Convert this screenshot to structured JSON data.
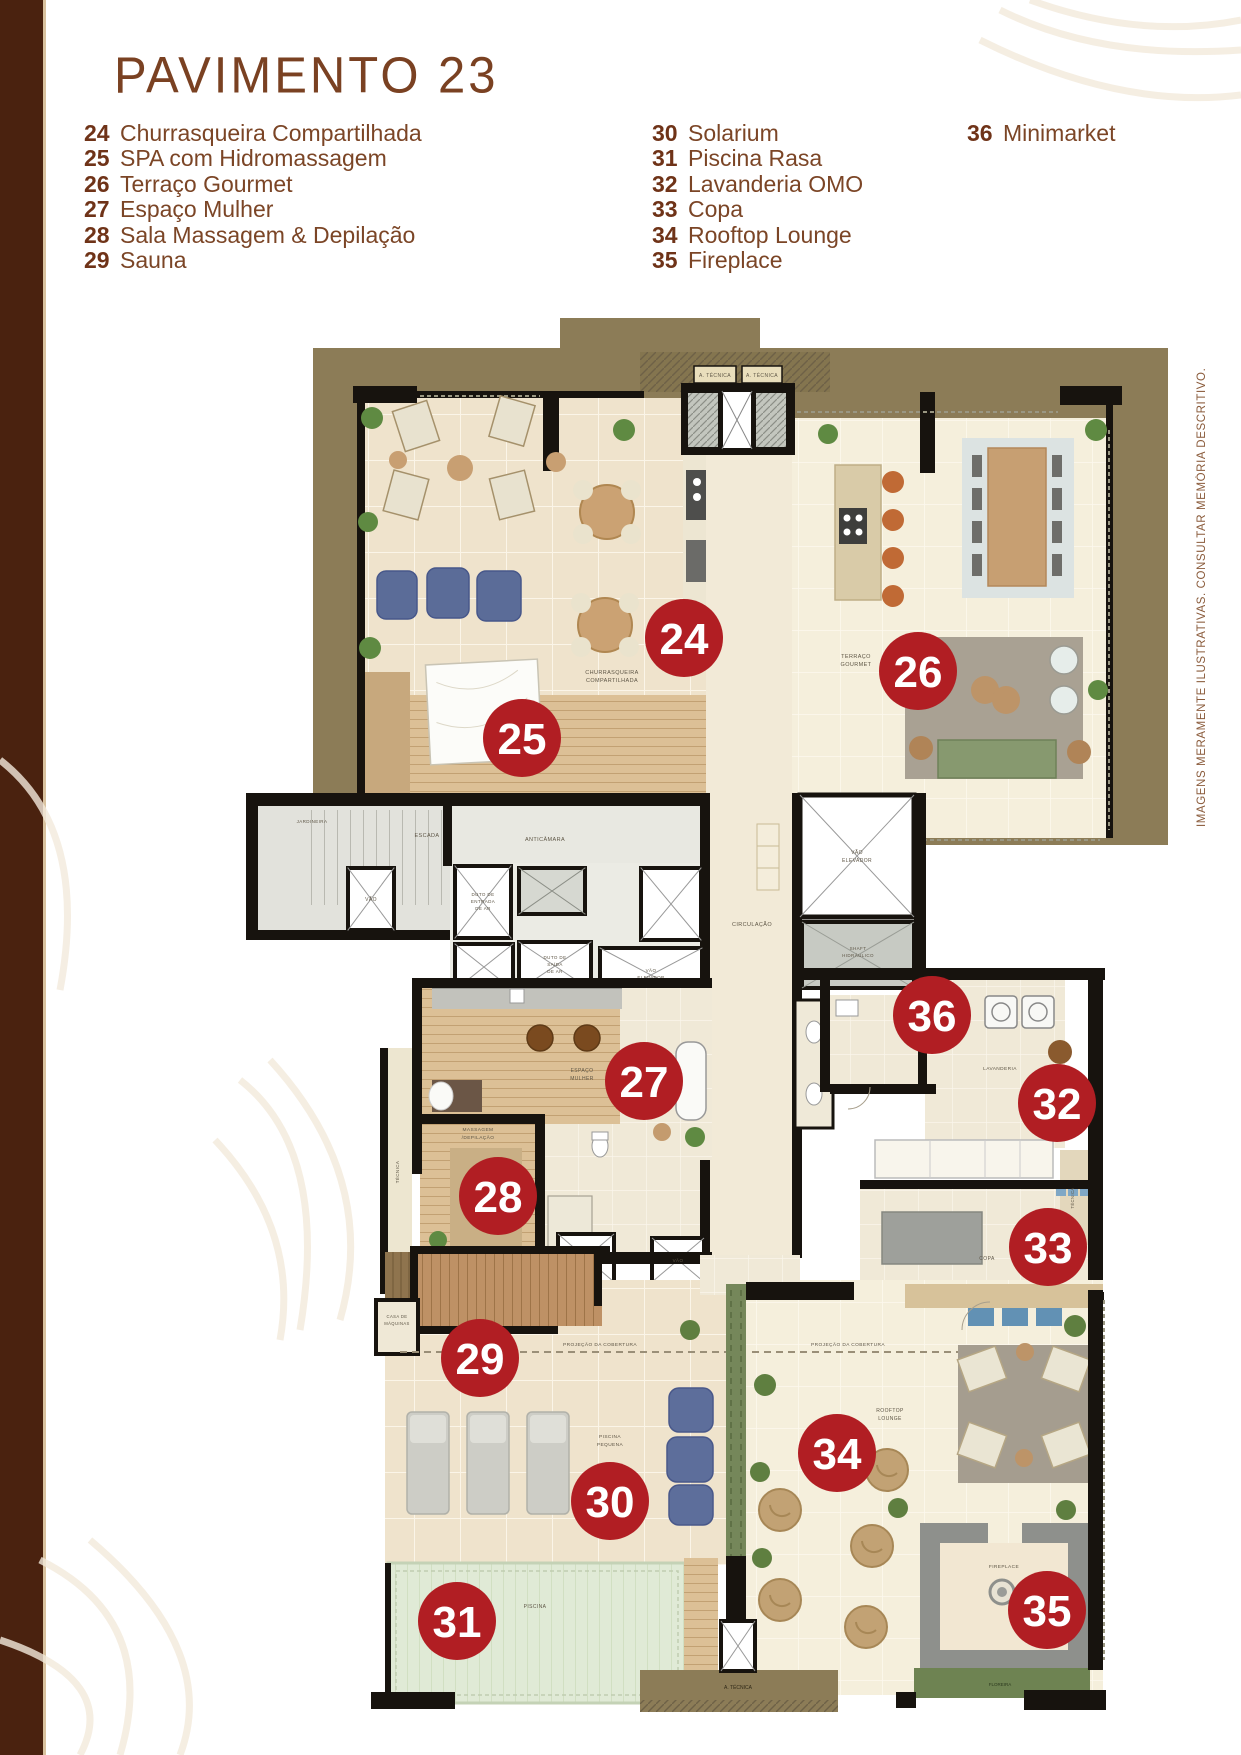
{
  "page": {
    "title": "PAVIMENTO 23",
    "disclaimer": "IMAGENS MERAMENTE ILUSTRATIVAS. CONSULTAR MEMÓRIA DESCRITIVO."
  },
  "legend": {
    "col1": [
      {
        "num": "24",
        "label": "Churrasqueira Compartilhada"
      },
      {
        "num": "25",
        "label": "SPA com Hidromassagem"
      },
      {
        "num": "26",
        "label": "Terraço Gourmet"
      },
      {
        "num": "27",
        "label": "Espaço Mulher"
      },
      {
        "num": "28",
        "label": "Sala Massagem & Depilação"
      },
      {
        "num": "29",
        "label": "Sauna"
      }
    ],
    "col2": [
      {
        "num": "30",
        "label": "Solarium"
      },
      {
        "num": "31",
        "label": "Piscina Rasa"
      },
      {
        "num": "32",
        "label": "Lavanderia OMO"
      },
      {
        "num": "33",
        "label": "Copa"
      },
      {
        "num": "34",
        "label": "Rooftop Lounge"
      },
      {
        "num": "35",
        "label": "Fireplace"
      }
    ],
    "col3": [
      {
        "num": "36",
        "label": "Minimarket"
      }
    ]
  },
  "plan": {
    "markers": [
      {
        "num": "24",
        "room": "Churrasqueira Compartilhada",
        "x": 684,
        "y": 638
      },
      {
        "num": "25",
        "room": "SPA com Hidromassagem",
        "x": 522,
        "y": 738
      },
      {
        "num": "26",
        "room": "Terraço Gourmet",
        "x": 918,
        "y": 671
      },
      {
        "num": "27",
        "room": "Espaço Mulher",
        "x": 644,
        "y": 1081
      },
      {
        "num": "28",
        "room": "Sala Massagem & Depilação",
        "x": 498,
        "y": 1196
      },
      {
        "num": "29",
        "room": "Sauna",
        "x": 480,
        "y": 1358
      },
      {
        "num": "30",
        "room": "Solarium",
        "x": 610,
        "y": 1501
      },
      {
        "num": "31",
        "room": "Piscina Rasa",
        "x": 457,
        "y": 1621
      },
      {
        "num": "32",
        "room": "Lavanderia OMO",
        "x": 1057,
        "y": 1103
      },
      {
        "num": "33",
        "room": "Copa",
        "x": 1048,
        "y": 1247
      },
      {
        "num": "34",
        "room": "Rooftop Lounge",
        "x": 837,
        "y": 1453
      },
      {
        "num": "35",
        "room": "Fireplace",
        "x": 1047,
        "y": 1610
      },
      {
        "num": "36",
        "room": "Minimarket",
        "x": 932,
        "y": 1015
      }
    ],
    "labels": {
      "churrasqueira_1": "CHURRASQUEIRA",
      "churrasqueira_2": "COMPARTILHADA",
      "terraco_1": "TERRAÇO",
      "terraco_2": "GOURMET",
      "escada": "ESCADA",
      "anticamara": "ANTICÂMARA",
      "vao": "VÃO",
      "jardineira": "JARDINEIRA",
      "duto_entrada_1": "DUTO DE",
      "duto_entrada_2": "ENTRADA",
      "duto_entrada_3": "DE AR",
      "duto_saida_1": "DUTO DE",
      "duto_saida_2": "SAÍDA",
      "duto_saida_3": "DE AR",
      "vao_elevador_1": "VÃO",
      "vao_elevador_2": "ELEVADOR",
      "circulacao": "CIRCULAÇÃO",
      "shaft_1": "SHAFT",
      "shaft_2": "HIDRÁULICO",
      "espaco_mulher_1": "ESPAÇO",
      "espaco_mulher_2": "MULHER",
      "massagem_1": "MASSAGEM",
      "massagem_2": "/DEPILAÇÃO",
      "tecnica": "TÉCNICA",
      "sauna": "SAUNA",
      "casa_maquinas_1": "CASA DE",
      "casa_maquinas_2": "MÁQUINAS",
      "projecao": "PROJEÇÃO DA COBERTURA",
      "piscina_pequena_1": "PISCINA",
      "piscina_pequena_2": "PEQUENA",
      "lavanderia": "LAVANDERIA",
      "copa": "COPA",
      "rooftop_1": "ROOFTOP",
      "rooftop_2": "LOUNGE",
      "fireplace": "FIREPLACE",
      "piscina": "PISCINA",
      "a_tecnica": "A. TÉCNICA",
      "floreira": "FLOREIRA"
    },
    "colors": {
      "marker": "#B11E23",
      "tan": "#8C7C57",
      "wall": "#17130E"
    }
  },
  "colors": {
    "accent_brown": "#7A4122",
    "legend_number": "#6F3318",
    "legend_label": "#7B4526",
    "border_brown": "#4A220F",
    "disclaimer_brown": "#8A5B3B"
  }
}
